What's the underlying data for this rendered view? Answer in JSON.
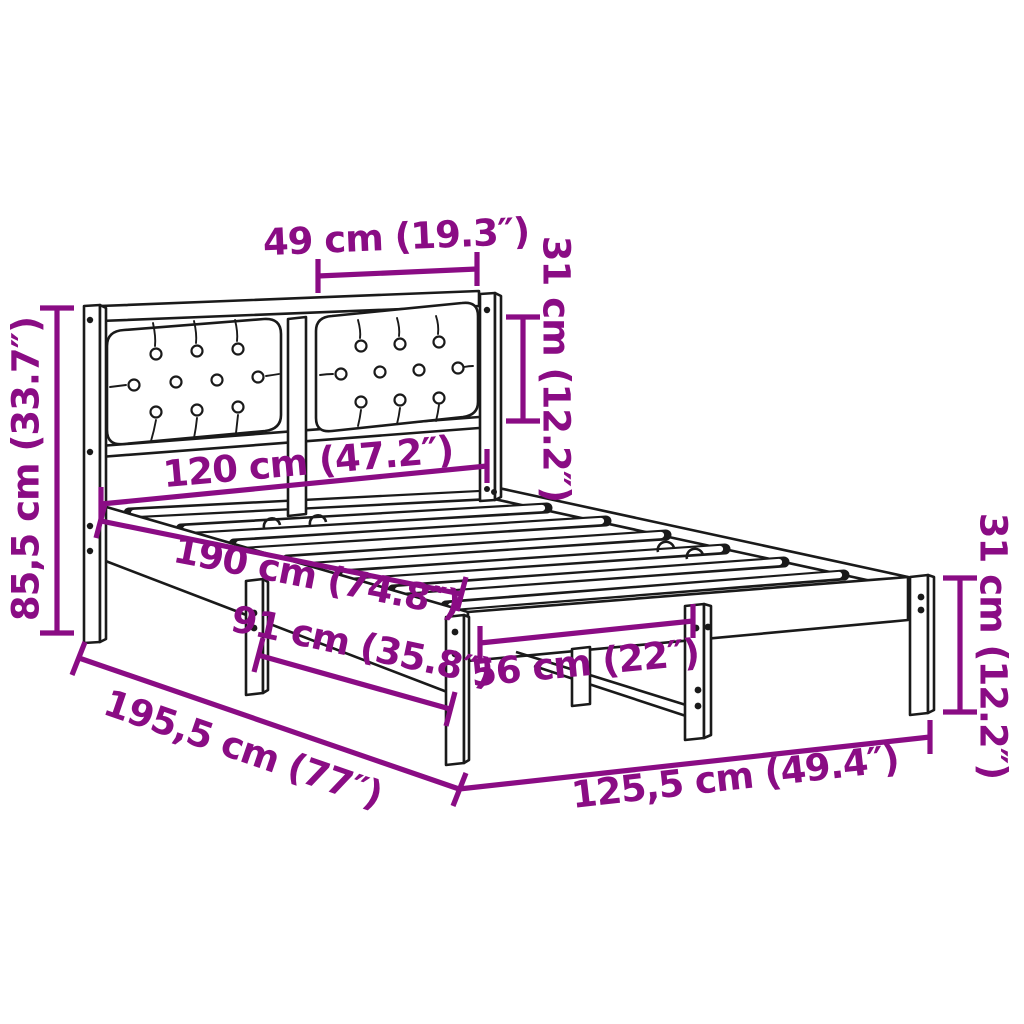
{
  "diagram": {
    "type": "product-dimension-diagram",
    "subject": "bed frame with upholstered tufted headboard and slatted base"
  },
  "colors": {
    "annotation": "#8A0C84",
    "line_art": "#1A1A1A",
    "background": "#FFFFFF"
  },
  "dimensions": {
    "headboard_cushion_width": "49 cm (19.3″)",
    "headboard_cushion_height": "31 cm (12.2″)",
    "headboard_height": "85,5 cm (33.7″)",
    "bed_width": "120 cm (47.2″)",
    "bed_length": "190 cm (74.8″)",
    "side_leg_spacing": "91 cm (35.8″)",
    "foot_leg_spacing": "56 cm (22″)",
    "overall_length": "195,5 cm (77″)",
    "overall_width": "125,5 cm (49.4″)",
    "leg_height": "31 cm (12.2″)"
  }
}
